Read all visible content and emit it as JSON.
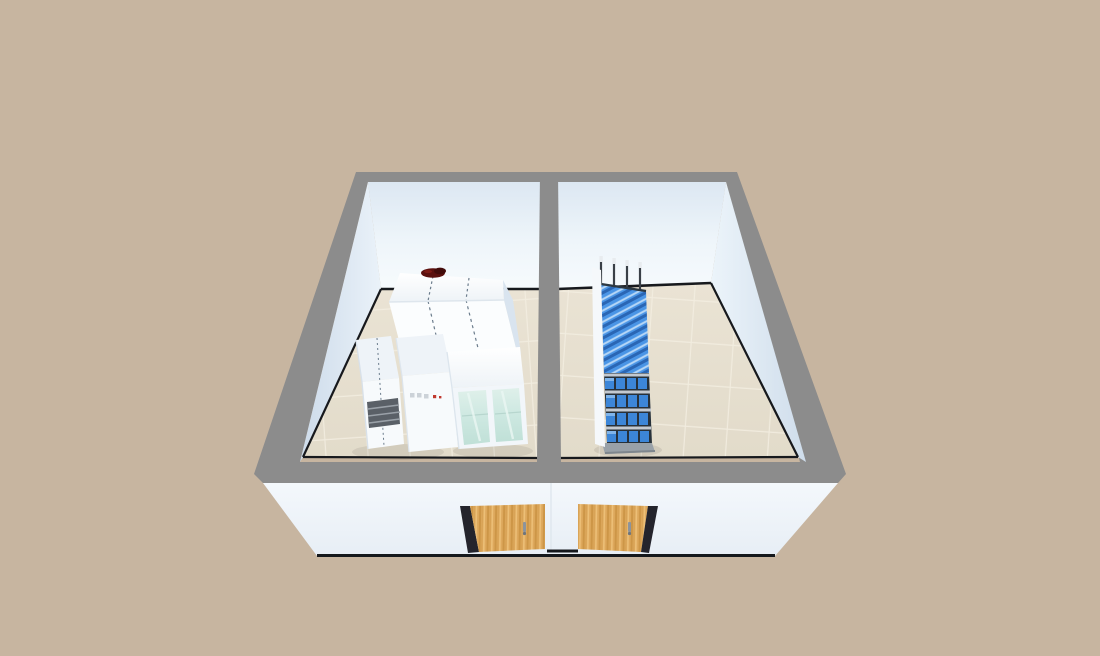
{
  "view": {
    "label": "3d-floorplan-overhead-view"
  },
  "colors": {
    "background": "#c7b5a0",
    "wallTop": "#8c8c8c",
    "skirting": "#17191d",
    "bottomEdge": "#15181c",
    "doorJamb": "#24242c",
    "doorHandle": "#8d949c",
    "grille": "#5a6067",
    "grilleSlat": "#9aa1a8",
    "redObject": "#5b100e",
    "redObjectDark": "#420b0a",
    "rackPanel": "#f5f8fb",
    "rackPost": "#3a4047",
    "rackPostTip": "#e8ecef",
    "rackBase": "#99a1a8",
    "rackBaseEdge": "#7e868d",
    "binBlue": "#3c86d8",
    "binBlueLight": "#7fb4ea",
    "binWell": "#27313a",
    "shelfGray": "#c3c9d0",
    "applianceWhite": "#f7fafc",
    "applianceTop": "#eef3f8",
    "wardrobeSide": "#d9e4ef",
    "indicatorRed": "#c0392f",
    "indicatorGray": "#ccd2d8",
    "seam": "#6b7c8c",
    "mullion": "#f2f6fa",
    "facadeSeam": "#dfe7ee",
    "shadow": "#000000"
  },
  "rooms": [
    {
      "name": "left-room",
      "furniture": [
        "wardrobe-row-3-doors",
        "appliance-with-vent-grille",
        "cabinet-with-indicator-lights",
        "glass-door-display-cabinet",
        "small-red-object-on-wardrobe"
      ]
    },
    {
      "name": "right-room",
      "furniture": [
        "blue-bin-storage-rack"
      ]
    }
  ],
  "doors": [
    {
      "name": "left-entry-door",
      "material": "wood"
    },
    {
      "name": "right-entry-door",
      "material": "wood"
    }
  ]
}
